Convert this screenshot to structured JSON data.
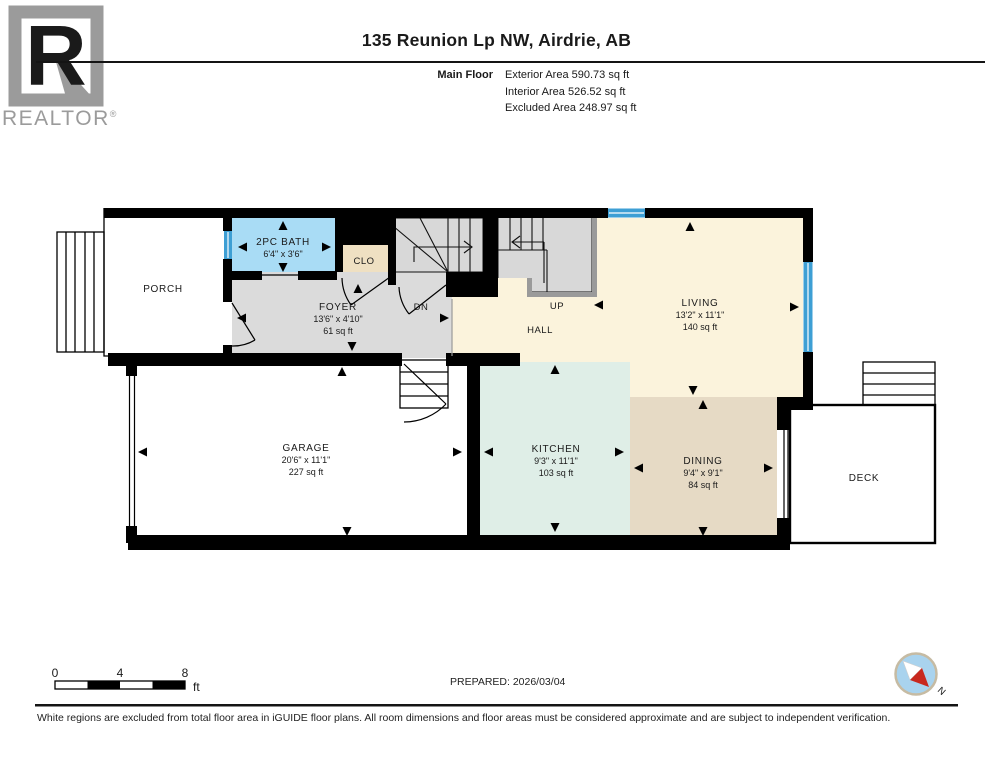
{
  "header": {
    "title": "135 Reunion Lp NW, Airdrie, AB",
    "floor_label": "Main Floor",
    "exterior_area": "Exterior Area 590.73 sq ft",
    "interior_area": "Interior Area 526.52 sq ft",
    "excluded_area": "Excluded Area 248.97 sq ft",
    "brand": {
      "logo_letter": "R",
      "name": "REALTOR",
      "registered": "®"
    }
  },
  "rooms": {
    "porch": {
      "name": "PORCH"
    },
    "bath": {
      "name": "2PC BATH",
      "dims": "6'4\" x 3'6\""
    },
    "closet": {
      "name": "CLO"
    },
    "foyer": {
      "name": "FOYER",
      "dims": "13'6\" x 4'10\"",
      "area": "61 sq ft"
    },
    "hall": {
      "name": "HALL"
    },
    "stairs": {
      "down": "DN",
      "up": "UP"
    },
    "living": {
      "name": "LIVING",
      "dims": "13'2\" x 11'1\"",
      "area": "140 sq ft"
    },
    "garage": {
      "name": "GARAGE",
      "dims": "20'6\" x 11'1\"",
      "area": "227 sq ft"
    },
    "kitchen": {
      "name": "KITCHEN",
      "dims": "9'3\" x 11'1\"",
      "area": "103 sq ft"
    },
    "dining": {
      "name": "DINING",
      "dims": "9'4\" x 9'1\"",
      "area": "84 sq ft"
    },
    "deck": {
      "name": "DECK"
    }
  },
  "footer": {
    "scale": {
      "ticks": [
        "0",
        "4",
        "8"
      ],
      "unit": "ft"
    },
    "prepared": "PREPARED: 2026/03/04",
    "compass_north": "N",
    "disclaimer": "White regions are excluded from total floor area in iGUIDE floor plans. All room dimensions and floor areas must be considered approximate and are subject to independent verification."
  },
  "colors": {
    "wall": "#000000",
    "window_blue": "#3E9FD4",
    "bath_blue": "#A9DCF5",
    "closet_tan": "#EFE0C2",
    "foyer_gray": "#DBDBDB",
    "stairs_gray": "#D8D8D8",
    "stairs_border_gray": "#9A9A9A",
    "living_cream": "#FBF3DC",
    "kitchen_mint": "#DFEEE7",
    "dining_tan": "#E6DAC5",
    "brand_gray": "#9B9B9B",
    "compass_blue": "#A9D3EE",
    "compass_red": "#C8281E"
  }
}
